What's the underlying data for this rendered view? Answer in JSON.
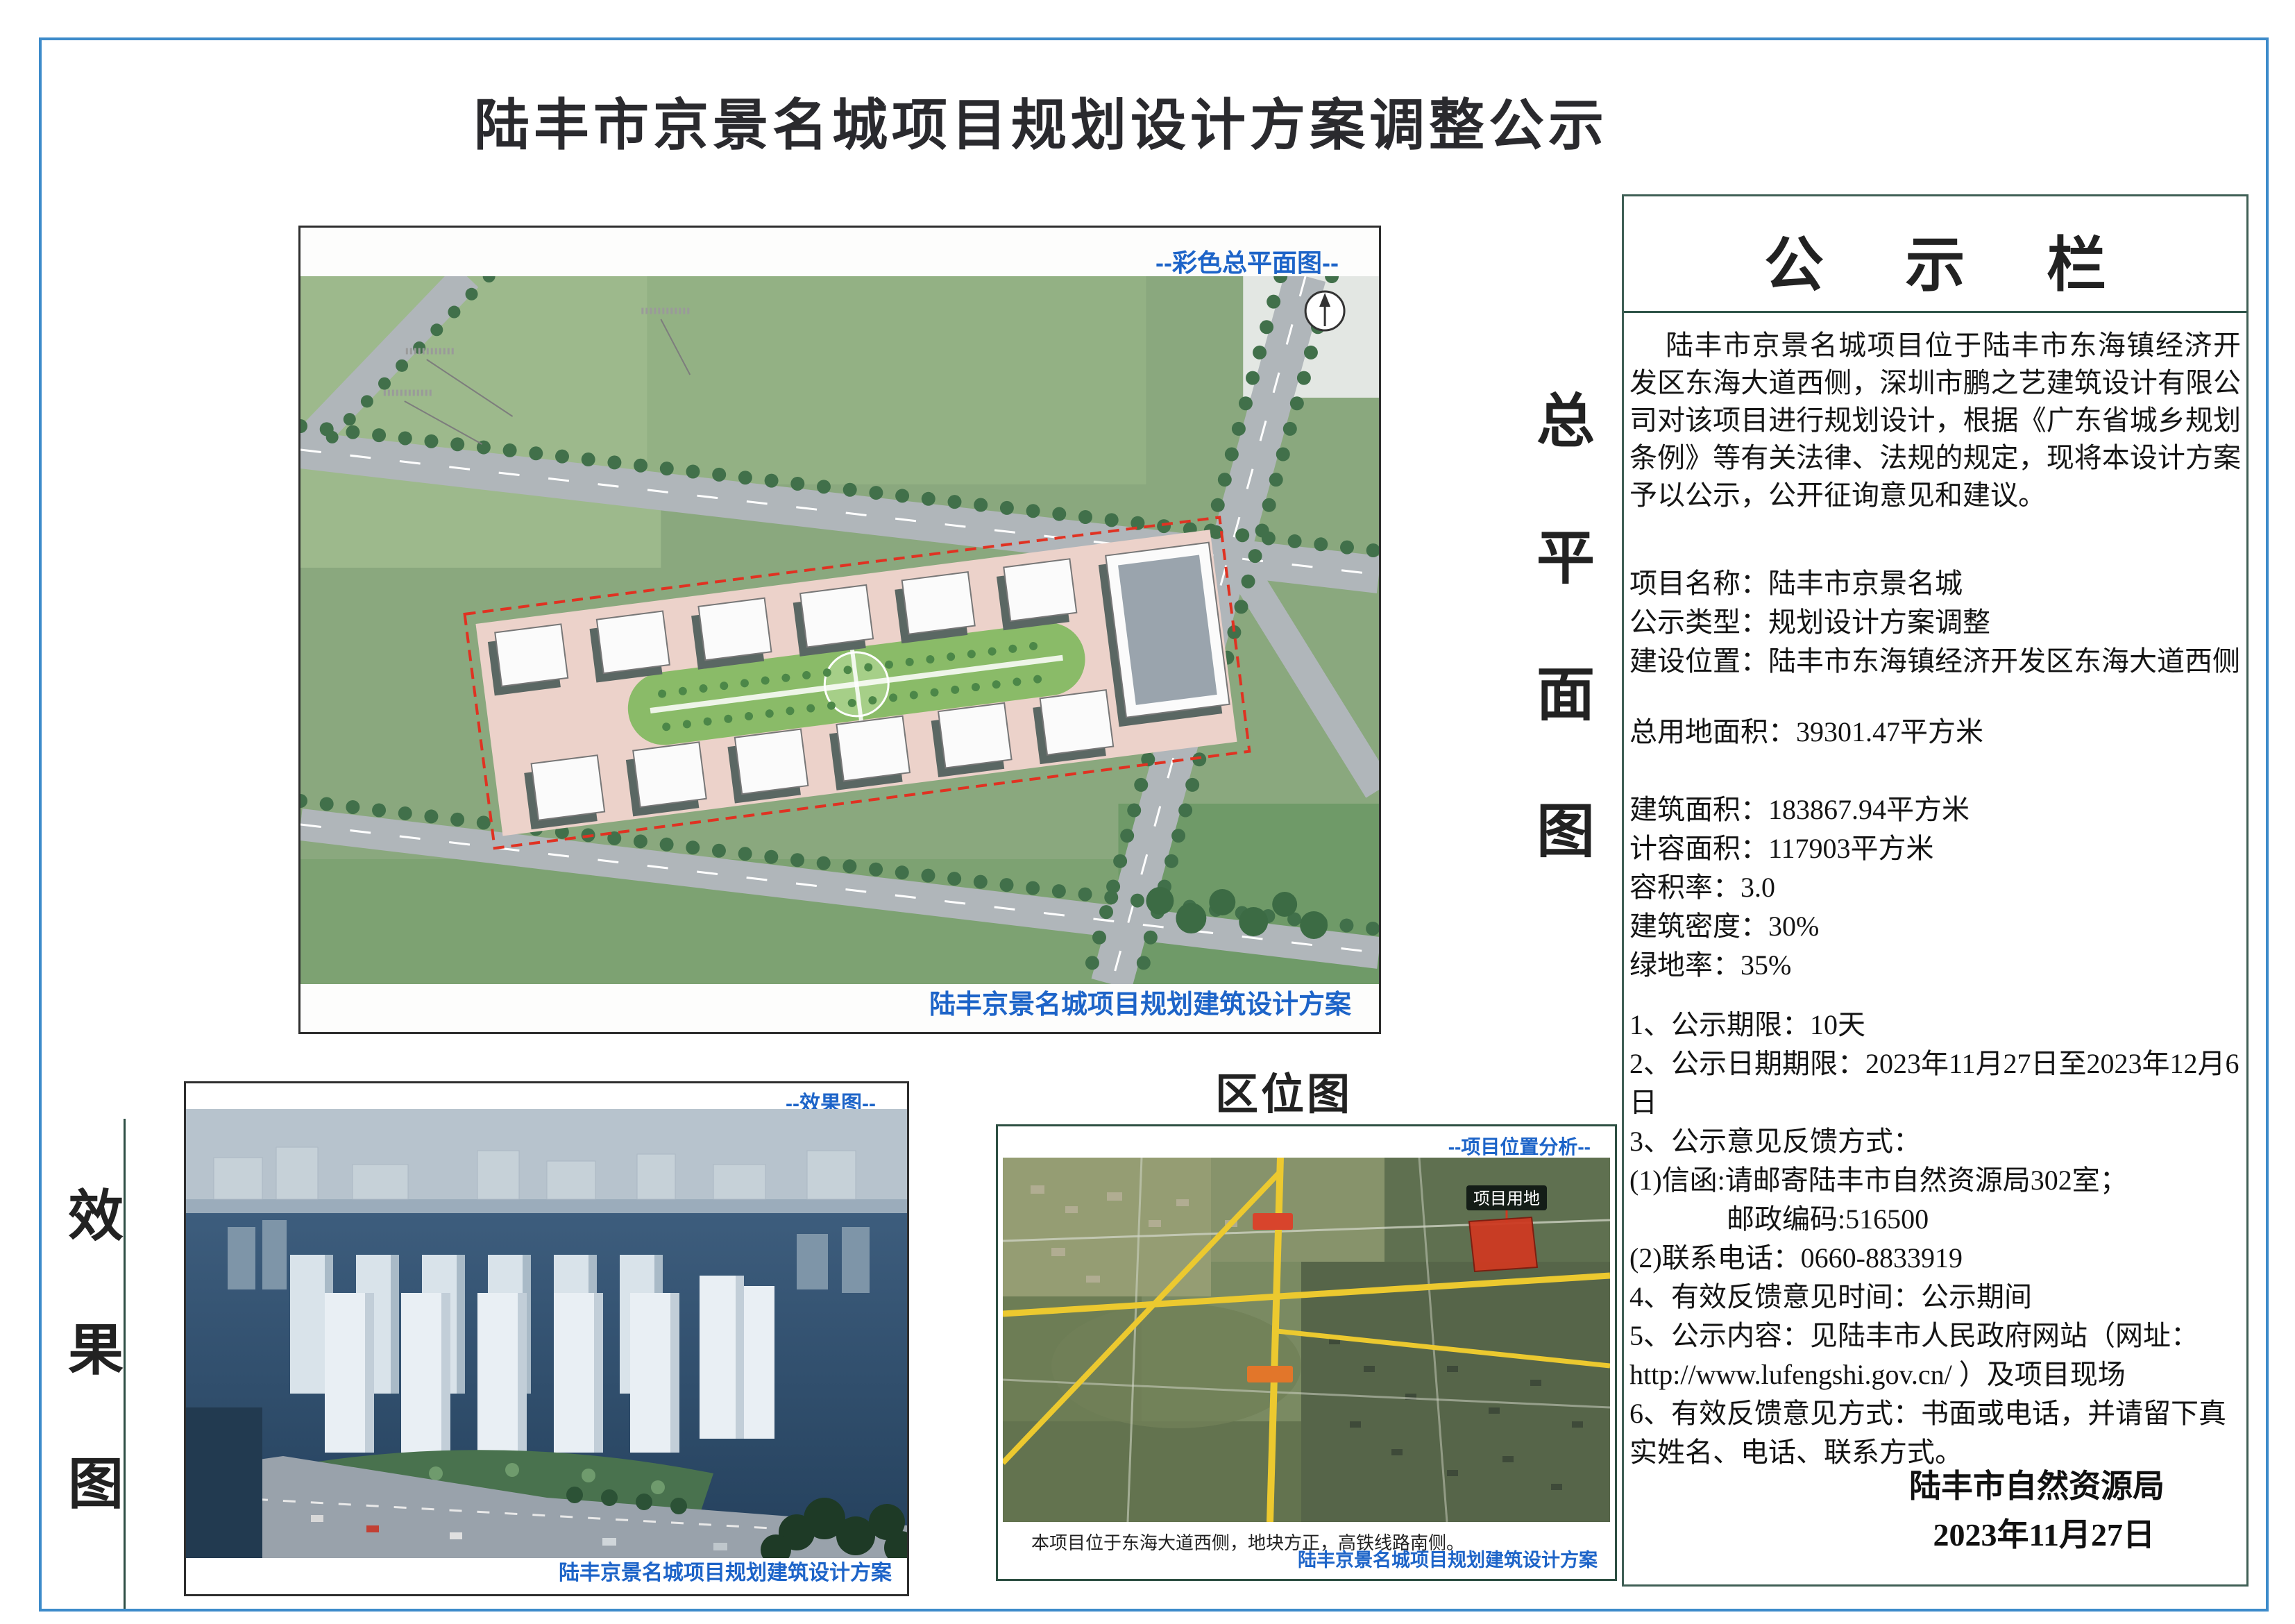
{
  "page": {
    "title": "陆丰市京景名城项目规划设计方案调整公示"
  },
  "master_plan": {
    "corner_label": "--彩色总平面图--",
    "caption": "陆丰京景名城项目规划建筑设计方案",
    "vertical_label": [
      "总",
      "平",
      "面",
      "图"
    ]
  },
  "effect": {
    "vertical_label": [
      "效",
      "果",
      "图"
    ],
    "corner_label": "--效果图--",
    "caption": "陆丰京景名城项目规划建筑设计方案"
  },
  "location": {
    "title": "区位图",
    "corner_label": "--项目位置分析--",
    "site_tag": "项目用地",
    "note": "本项目位于东海大道西侧，地块方正，高铁线路南侧。",
    "caption": "陆丰京景名城项目规划建筑设计方案"
  },
  "notice": {
    "header": "公 示 栏",
    "intro": "陆丰市京景名城项目位于陆丰市东海镇经济开发区东海大道西侧，深圳市鹏之艺建筑设计有限公司对该项目进行规划设计，根据《广东省城乡规划条例》等有关法律、法规的规定，现将本设计方案予以公示，公开征询意见和建议。",
    "lines": [
      {
        "text": "项目名称：陆丰市京景名城",
        "class": ""
      },
      {
        "text": "公示类型：规划设计方案调整",
        "class": ""
      },
      {
        "text": "建设位置：陆丰市东海镇经济开发区东海大道西侧",
        "class": ""
      },
      {
        "text": "总用地面积：39301.47平方米",
        "class": "gap-md"
      },
      {
        "text": "建筑面积：183867.94平方米",
        "class": "gap-lg"
      },
      {
        "text": "计容面积：117903平方米",
        "class": ""
      },
      {
        "text": "容积率：3.0",
        "class": ""
      },
      {
        "text": "建筑密度：30%",
        "class": ""
      },
      {
        "text": "绿地率：35%",
        "class": ""
      },
      {
        "text": "1、公示期限：10天",
        "class": "gap-sm"
      },
      {
        "text": "2、公示日期期限：2023年11月27日至2023年12月6日",
        "class": ""
      },
      {
        "text": "3、公示意见反馈方式：",
        "class": ""
      },
      {
        "text": "(1)信函:请邮寄陆丰市自然资源局302室；",
        "class": ""
      },
      {
        "text": "邮政编码:516500",
        "class": "indent"
      },
      {
        "text": "(2)联系电话：0660-8833919",
        "class": ""
      },
      {
        "text": "4、有效反馈意见时间：公示期间",
        "class": ""
      },
      {
        "text": "5、公示内容：见陆丰市人民政府网站（网址： http://www.lufengshi.gov.cn/ ）及项目现场",
        "class": ""
      },
      {
        "text": "6、有效反馈意见方式：书面或电话，并请留下真实姓名、电话、联系方式。",
        "class": ""
      }
    ],
    "signature": "陆丰市自然资源局",
    "date": "2023年11月27日"
  }
}
